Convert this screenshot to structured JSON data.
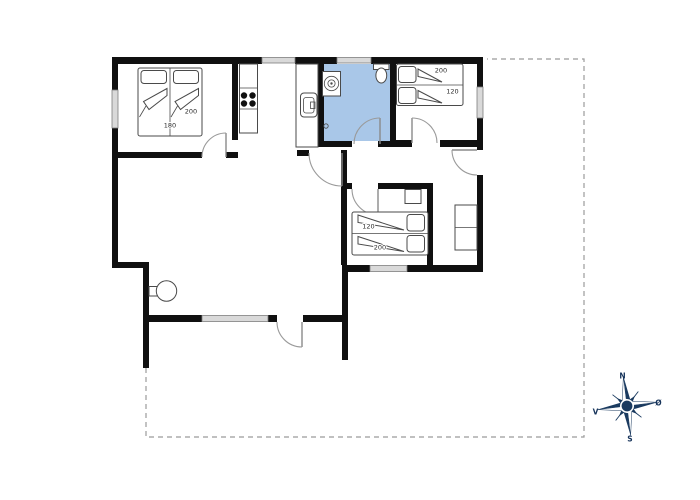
{
  "plan": {
    "beds": {
      "bed1": {
        "length": "200",
        "width": "180"
      },
      "bed2": {
        "length": "200",
        "width": "120"
      },
      "bed3": {
        "width": "120",
        "length": "200"
      }
    },
    "compass": {
      "north": "N",
      "east": "Ø",
      "south": "S",
      "west": "V"
    },
    "colors": {
      "wall": "#101010",
      "bathroom_fill": "#a9c7e8",
      "window_fill": "#d9d9d9",
      "compass_navy": "#1a3a5f",
      "boundary_dash": "#9b9b9b"
    }
  }
}
